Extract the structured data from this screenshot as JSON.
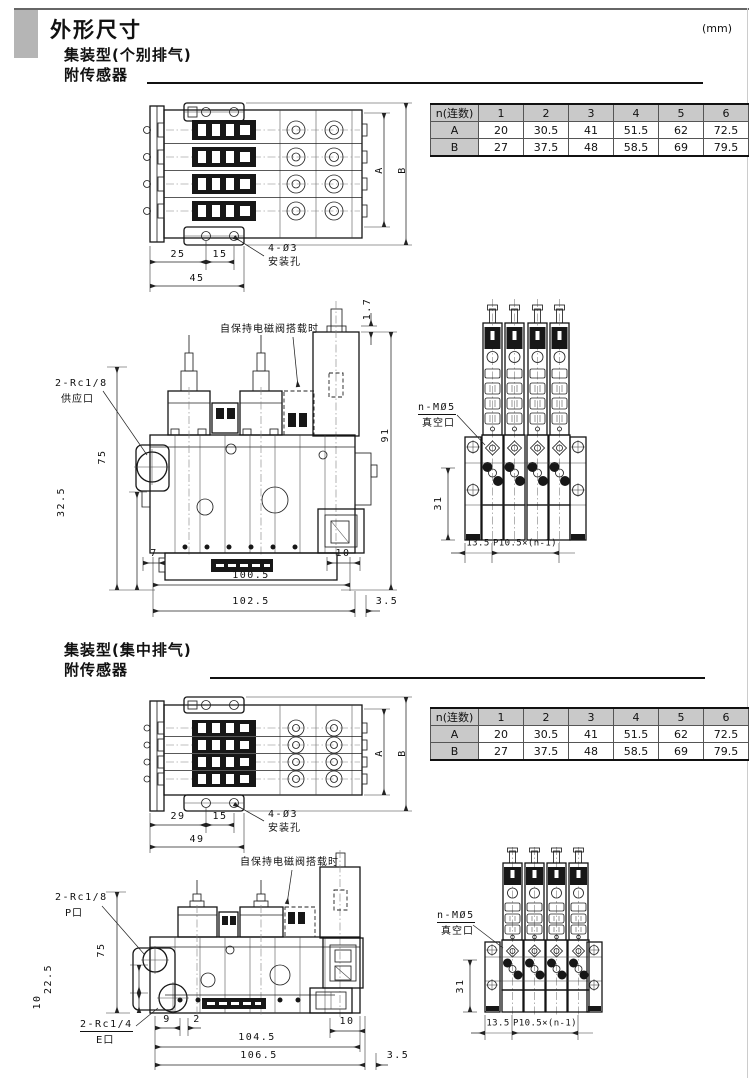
{
  "page": {
    "title": "外形尺寸",
    "unit": "(mm)"
  },
  "sections": [
    {
      "heading1": "集装型(个别排气)",
      "heading2": "附传感器",
      "table": {
        "header": [
          "n(连数)",
          "1",
          "2",
          "3",
          "4",
          "5",
          "6"
        ],
        "rows": [
          {
            "label": "A",
            "values": [
              "20",
              "30.5",
              "41",
              "51.5",
              "62",
              "72.5"
            ]
          },
          {
            "label": "B",
            "values": [
              "27",
              "37.5",
              "48",
              "58.5",
              "69",
              "79.5"
            ]
          }
        ]
      },
      "top_view": {
        "dim1": "25",
        "dim2": "15",
        "dim_total": "45",
        "dim_a": "A",
        "dim_b": "B",
        "hole": "4-Ø3",
        "hole_name": "安装孔"
      },
      "front_view": {
        "port": "2-Rc1/8",
        "port_name": "供应口",
        "note": "自保持电磁阀搭载时",
        "dim_top": "1.7",
        "dim_valve": "91",
        "dim_height": "75",
        "dim_mid": "32.5",
        "dim_left": "7",
        "dim_right": "10",
        "dim_body": "100.5",
        "dim_overall": "102.5",
        "dim_end": "3.5"
      },
      "side_view": {
        "port": "n-MØ5",
        "port_name": "真空口",
        "dim_height": "31",
        "dim_first": "13.5",
        "dim_pitch": "P10.5×(n-1)"
      }
    },
    {
      "heading1": "集装型(集中排气)",
      "heading2": "附传感器",
      "table": {
        "header": [
          "n(连数)",
          "1",
          "2",
          "3",
          "4",
          "5",
          "6"
        ],
        "rows": [
          {
            "label": "A",
            "values": [
              "20",
              "30.5",
              "41",
              "51.5",
              "62",
              "72.5"
            ]
          },
          {
            "label": "B",
            "values": [
              "27",
              "37.5",
              "48",
              "58.5",
              "69",
              "79.5"
            ]
          }
        ]
      },
      "top_view": {
        "dim1": "29",
        "dim2": "15",
        "dim_total": "49",
        "dim_a": "A",
        "dim_b": "B",
        "hole": "4-Ø3",
        "hole_name": "安装孔"
      },
      "front_view": {
        "port": "2-Rc1/8",
        "port_name": "P口",
        "port2": "2-Rc1/4",
        "port2_name": "E口",
        "note": "自保持电磁阀搭载时",
        "dim_height": "75",
        "dim_mid": "22.5",
        "dim_low": "10",
        "dim_a": "9",
        "dim_b": "2",
        "dim_right": "10",
        "dim_body": "104.5",
        "dim_overall": "106.5",
        "dim_end": "3.5"
      },
      "side_view": {
        "port": "n-MØ5",
        "port_name": "真空口",
        "dim_height": "31",
        "dim_first": "13.5",
        "dim_pitch": "P10.5×(n-1)"
      }
    }
  ]
}
